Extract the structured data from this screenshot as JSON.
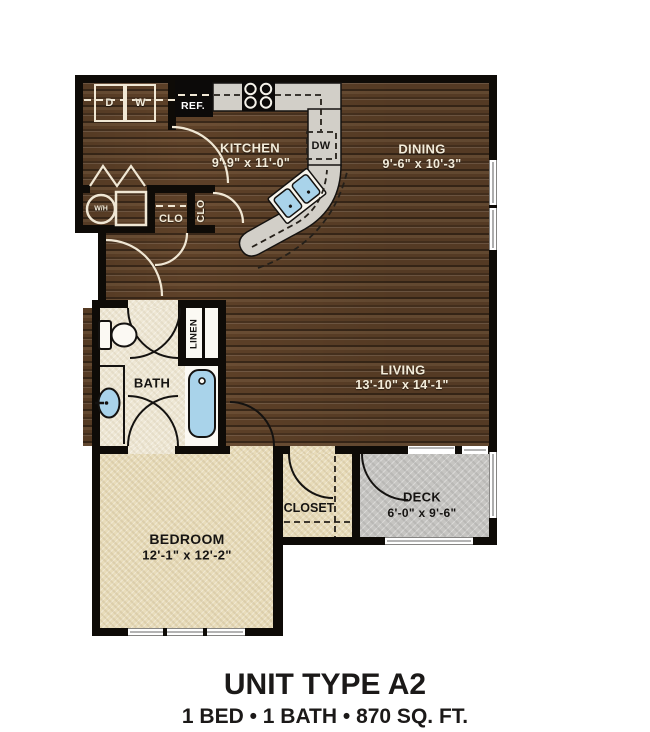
{
  "caption": {
    "title": "UNIT TYPE A2",
    "subtitle": "1 BED • 1 BATH • 870 SQ. FT."
  },
  "rooms": {
    "kitchen": {
      "name": "KITCHEN",
      "dims": "9'-9\" x 11'-0\""
    },
    "dining": {
      "name": "DINING",
      "dims": "9'-6\" x 10'-3\""
    },
    "living": {
      "name": "LIVING",
      "dims": "13'-10\" x 14'-1\""
    },
    "bedroom": {
      "name": "BEDROOM",
      "dims": "12'-1\" x 12'-2\""
    },
    "deck": {
      "name": "DECK",
      "dims": "6'-0\" x 9'-6\""
    },
    "bath": {
      "name": "BATH"
    },
    "closet": {
      "name": "CLOSET"
    },
    "linen": {
      "name": "LINEN"
    },
    "closet_small_1": {
      "name": "CLO"
    },
    "closet_small_2": {
      "name": "CLO"
    }
  },
  "appliances": {
    "dryer": "D",
    "washer": "W",
    "refrigerator": "REF.",
    "dishwasher": "DW",
    "water_heater": "W/H"
  },
  "colors": {
    "wall": "#0e0b07",
    "wood_floor": "#5e4128",
    "carpet": "#e8dcba",
    "bath_floor": "#eee7d4",
    "deck_floor": "#c6c5c2",
    "counter": "#d2cfc8",
    "fixture_blue": "#a9d3ea"
  }
}
